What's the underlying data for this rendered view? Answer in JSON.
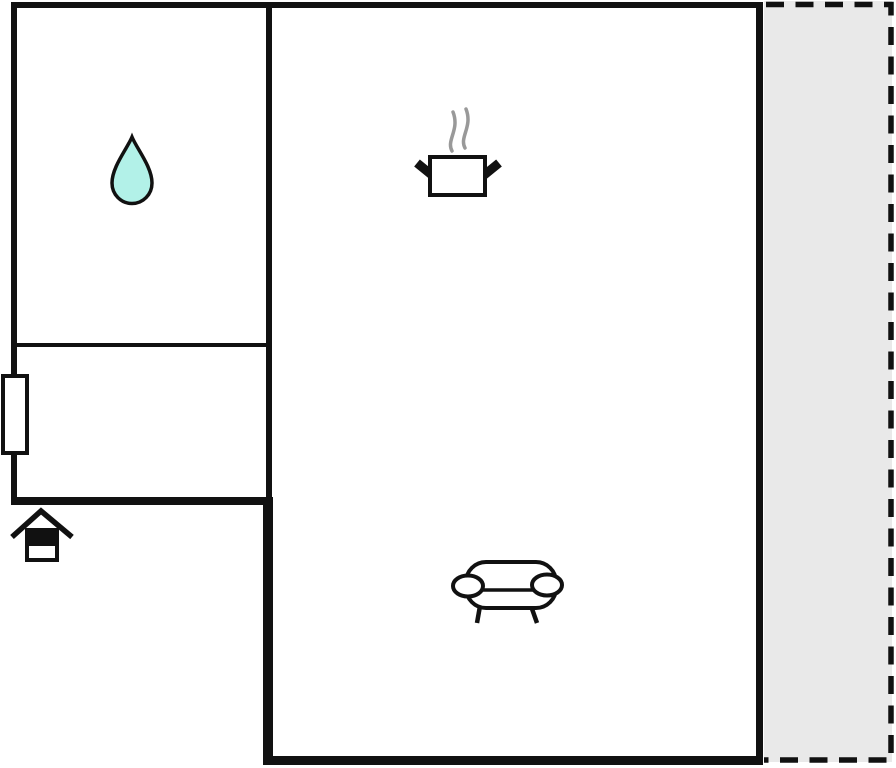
{
  "floorplan": {
    "type": "floor_plan",
    "colors": {
      "background": "#ffffff",
      "wall": "#111111",
      "terrace_fill": "#e9e9e9",
      "terrace_border": "#111111",
      "water_drop_fill": "#b2f1e8",
      "steam": "#999999",
      "icon_fill": "#ffffff",
      "icon_outline": "#111111"
    },
    "areas": [
      {
        "id": "room-upper-left",
        "icons": [
          "water-drop-icon"
        ]
      },
      {
        "id": "room-lower-left",
        "icons": [
          "window-symbol"
        ]
      },
      {
        "id": "room-main",
        "icons": [
          "cooking-pot-icon",
          "sofa-icon"
        ]
      },
      {
        "id": "terrace",
        "outline": "dashed"
      },
      {
        "id": "outside",
        "icons": [
          "entrance-house-icon"
        ]
      }
    ],
    "icons": [
      {
        "name": "water-drop-icon"
      },
      {
        "name": "steam-icon"
      },
      {
        "name": "cooking-pot-icon"
      },
      {
        "name": "sofa-icon"
      },
      {
        "name": "window-symbol"
      },
      {
        "name": "entrance-house-icon"
      }
    ]
  }
}
